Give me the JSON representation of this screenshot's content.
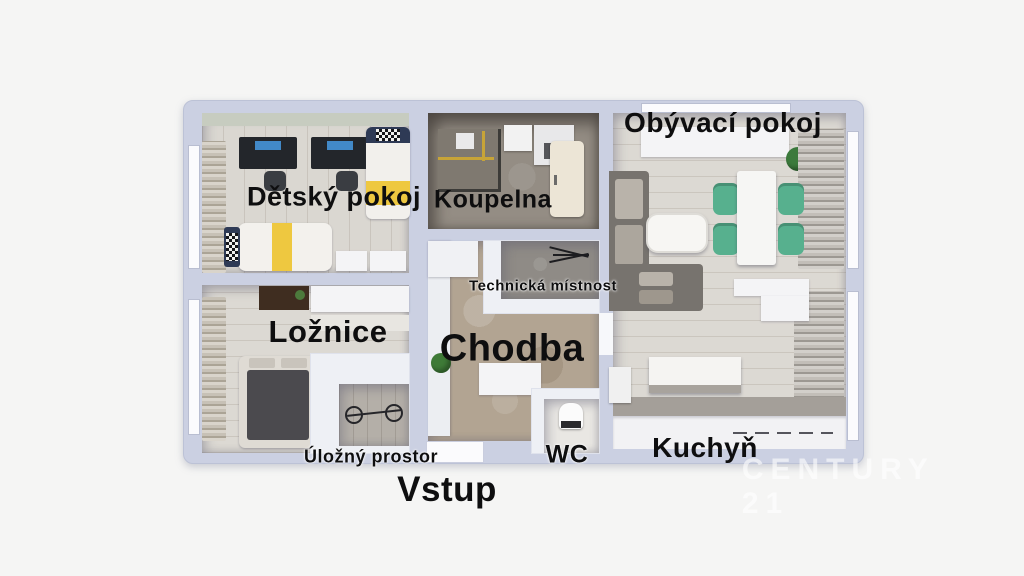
{
  "meta": {
    "type": "apartment-floor-plan-3d-render"
  },
  "labels": {
    "detsky_pokoj": "Dětský pokoj",
    "koupelna": "Koupelna",
    "obyvaci_pokoj": "Obývací pokoj",
    "technicka_mistnost": "Technická místnost",
    "loznice": "Ložnice",
    "chodba": "Chodba",
    "ulozny_prostor": "Úložný prostor",
    "wc": "WC",
    "kuchyn": "Kuchyň",
    "vstup": "Vstup"
  },
  "watermark": "CENTURY 21",
  "colors": {
    "background": "#f5f5f4",
    "wall": "#cbd0e2",
    "label_text": "#0e0e0f",
    "accent_yellow": "#eec840",
    "chair_green": "#57b08e",
    "hall_floor": "#b2a492",
    "bath_floor": "#948d84",
    "wood_floor": "#dad7d1"
  }
}
